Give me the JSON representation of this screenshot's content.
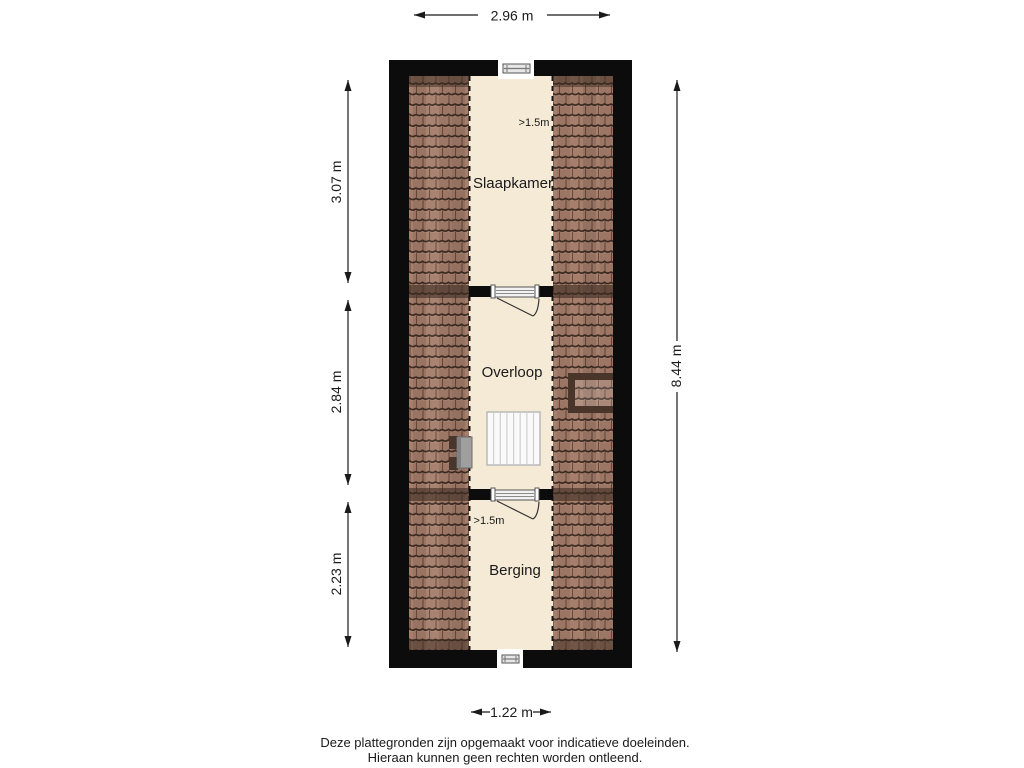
{
  "floorplan": {
    "rooms": [
      {
        "label": "Slaapkamer",
        "height_note": ">1.5m"
      },
      {
        "label": "Overloop"
      },
      {
        "label": "Berging",
        "height_note": ">1.5m"
      }
    ],
    "dimensions": {
      "top": "2.96 m",
      "left_top": "3.07 m",
      "left_middle": "2.84 m",
      "left_bottom": "2.23 m",
      "right": "8.44 m",
      "bottom": "1.22 m"
    },
    "disclaimer": {
      "line1": "Deze plattegronden zijn opgemaakt voor indicatieve doeleinden.",
      "line2": "Hieraan kunnen geen rechten worden ontleend."
    },
    "colors": {
      "wall": "#0c0c0c",
      "floor": "#f5ead6",
      "roof_tile": "#a67e6c",
      "roof_tile_line": "#3f2d23",
      "text": "#1a1a1a"
    }
  }
}
